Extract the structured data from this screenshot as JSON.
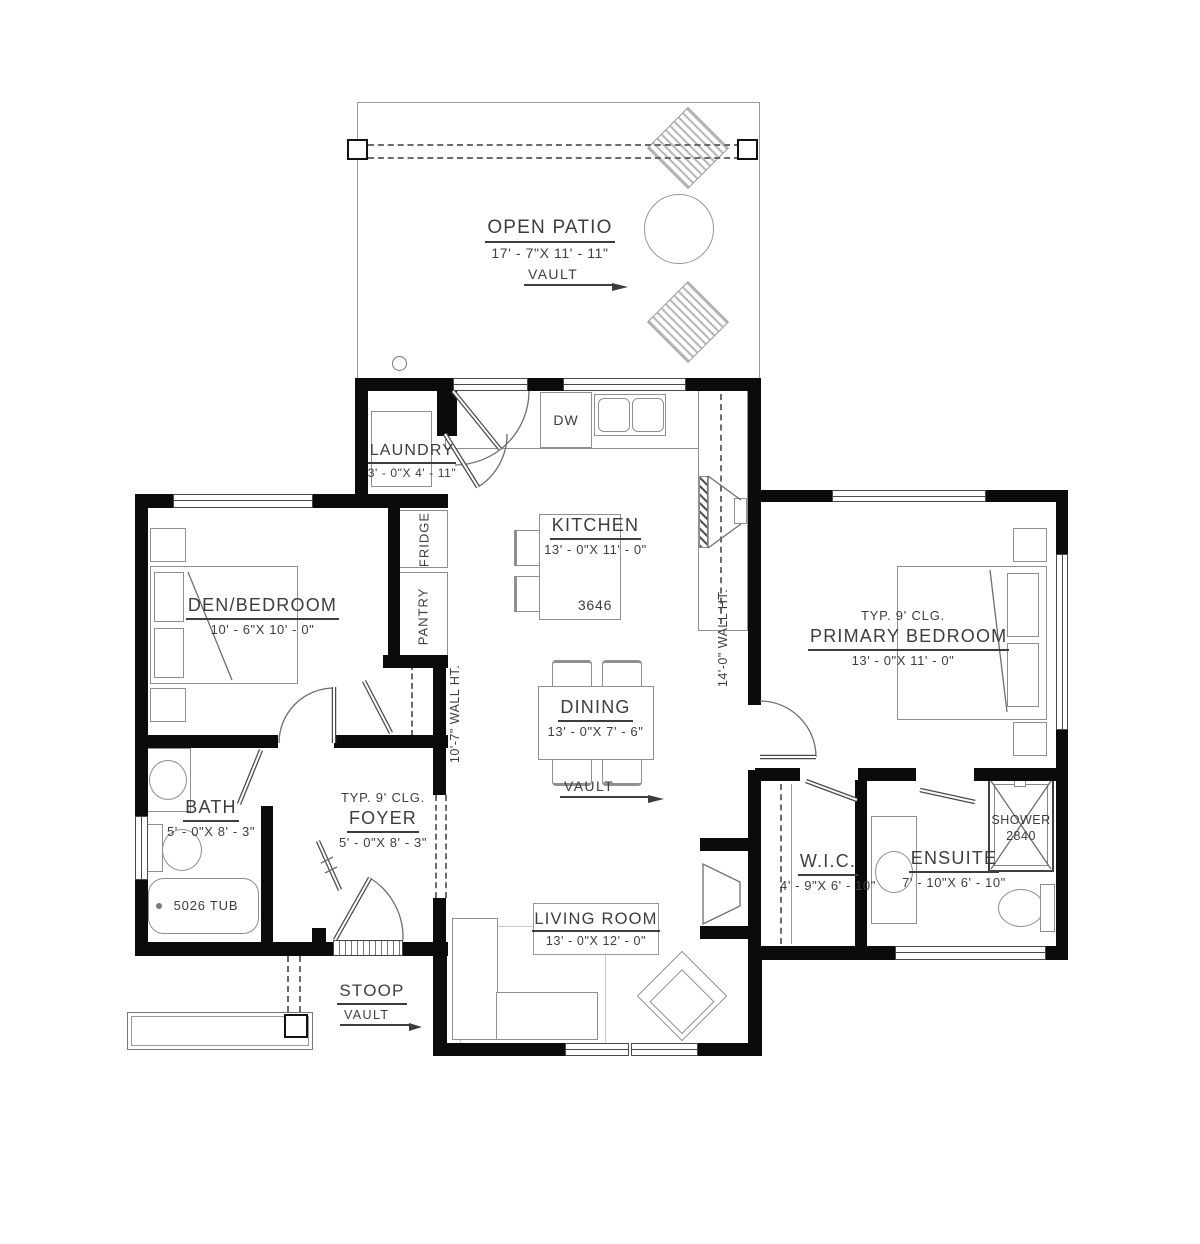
{
  "rooms": {
    "open_patio": {
      "name": "OPEN PATIO",
      "dims": "17' - 7\"X 11' - 11\"",
      "vault_label": "VAULT"
    },
    "laundry": {
      "name": "LAUNDRY",
      "dims": "3' - 0\"X 4' - 11\""
    },
    "kitchen": {
      "name": "KITCHEN",
      "dims": "13' - 0\"X 11' - 0\"",
      "island_size": "3646"
    },
    "den_bedroom": {
      "name": "DEN/BEDROOM",
      "dims": "10' - 6\"X 10' - 0\""
    },
    "primary_bedroom": {
      "ceiling_note": "TYP. 9' CLG.",
      "name": "PRIMARY BEDROOM",
      "dims": "13' - 0\"X 11' - 0\""
    },
    "dining": {
      "name": "DINING",
      "dims": "13' - 0\"X 7' - 6\"",
      "vault_label": "VAULT"
    },
    "bath": {
      "name": "BATH",
      "dims": "5' - 0\"X 8' - 3\"",
      "tub_label": "5026 TUB"
    },
    "foyer": {
      "ceiling_note": "TYP. 9' CLG.",
      "name": "FOYER",
      "dims": "5' - 0\"X 8' - 3\""
    },
    "living_room": {
      "name": "LIVING ROOM",
      "dims": "13' - 0\"X 12' - 0\""
    },
    "wic": {
      "name": "W.I.C.",
      "dims": "4' - 9\"X 6' - 10\""
    },
    "ensuite": {
      "name": "ENSUITE",
      "dims": "7' - 10\"X 6' - 10\"",
      "shower_label": "SHOWER",
      "shower_size": "2840"
    },
    "stoop": {
      "name": "STOOP",
      "vault_label": "VAULT"
    }
  },
  "appliances": {
    "dishwasher": "DW",
    "fridge": "FRIDGE",
    "pantry": "PANTRY"
  },
  "annotations": {
    "wall_height_left": "10'-7\" WALL HT.",
    "wall_height_right": "14'-0\" WALL HT."
  },
  "colors": {
    "wall": "#0b0b0b",
    "furniture_line": "#8f8f8f",
    "text": "#3d3d3d"
  }
}
